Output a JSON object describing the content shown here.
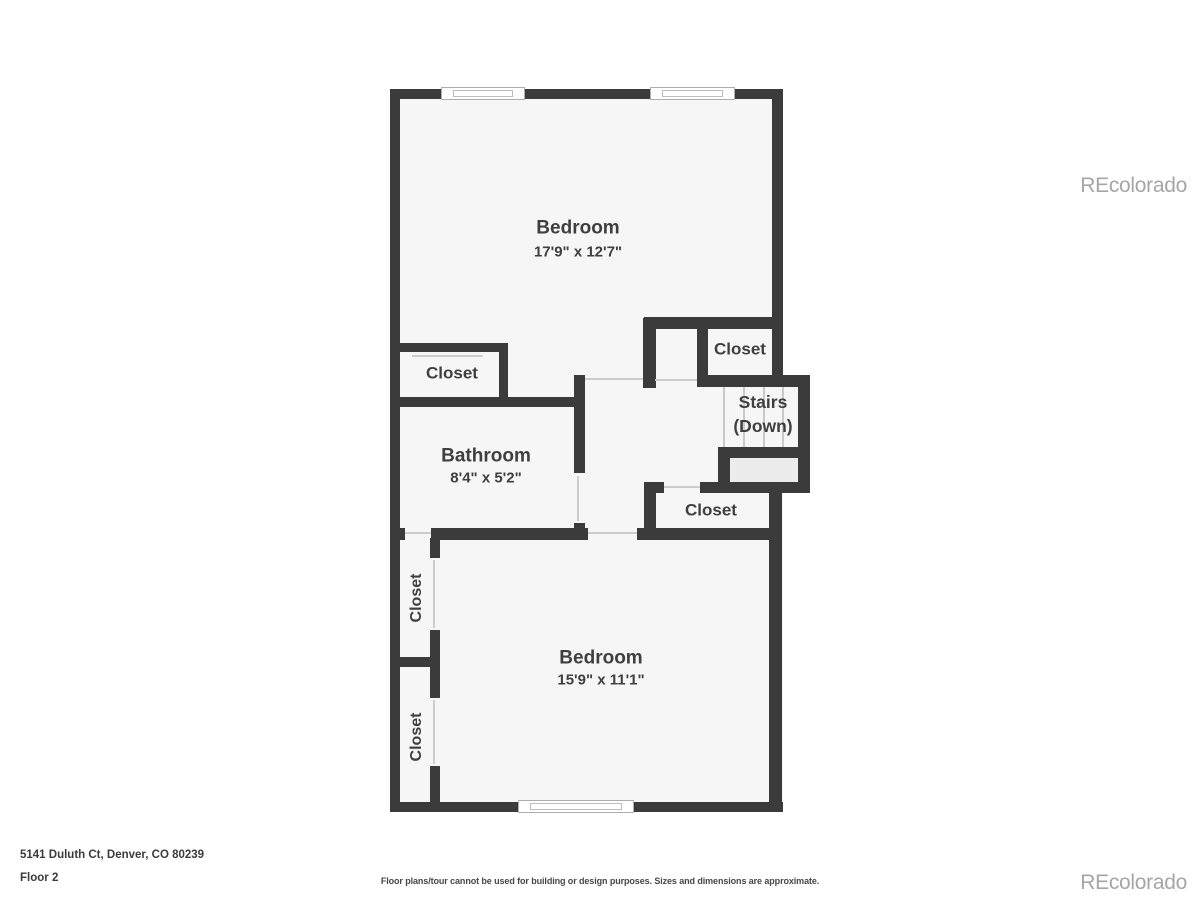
{
  "plan": {
    "rooms": {
      "bedroom_top": {
        "name": "Bedroom",
        "dims": "17'9\" x 12'7\""
      },
      "closet_top_left": {
        "name": "Closet"
      },
      "closet_top_right": {
        "name": "Closet"
      },
      "stairs": {
        "line1": "Stairs",
        "line2": "(Down)"
      },
      "bathroom": {
        "name": "Bathroom",
        "dims": "8'4\" x 5'2\""
      },
      "closet_mid": {
        "name": "Closet"
      },
      "closet_left_a": {
        "name": "Closet"
      },
      "closet_left_b": {
        "name": "Closet"
      },
      "bedroom_bottom": {
        "name": "Bedroom",
        "dims": "15'9\" x 11'1\""
      }
    }
  },
  "footer": {
    "address": "5141 Duluth Ct, Denver, CO 80239",
    "floor": "Floor 2",
    "disclaimer": "Floor plans/tour cannot be used for building or design purposes. Sizes and dimensions are approximate."
  },
  "watermark": {
    "text": "REcolorado"
  },
  "colors": {
    "wall": "#3b3b3b",
    "floor": "#f6f6f6",
    "landing": "#ececec",
    "door_line": "#cccccc",
    "label_text": "#3f3f3f",
    "watermark_gray": "#a6a6a6"
  }
}
